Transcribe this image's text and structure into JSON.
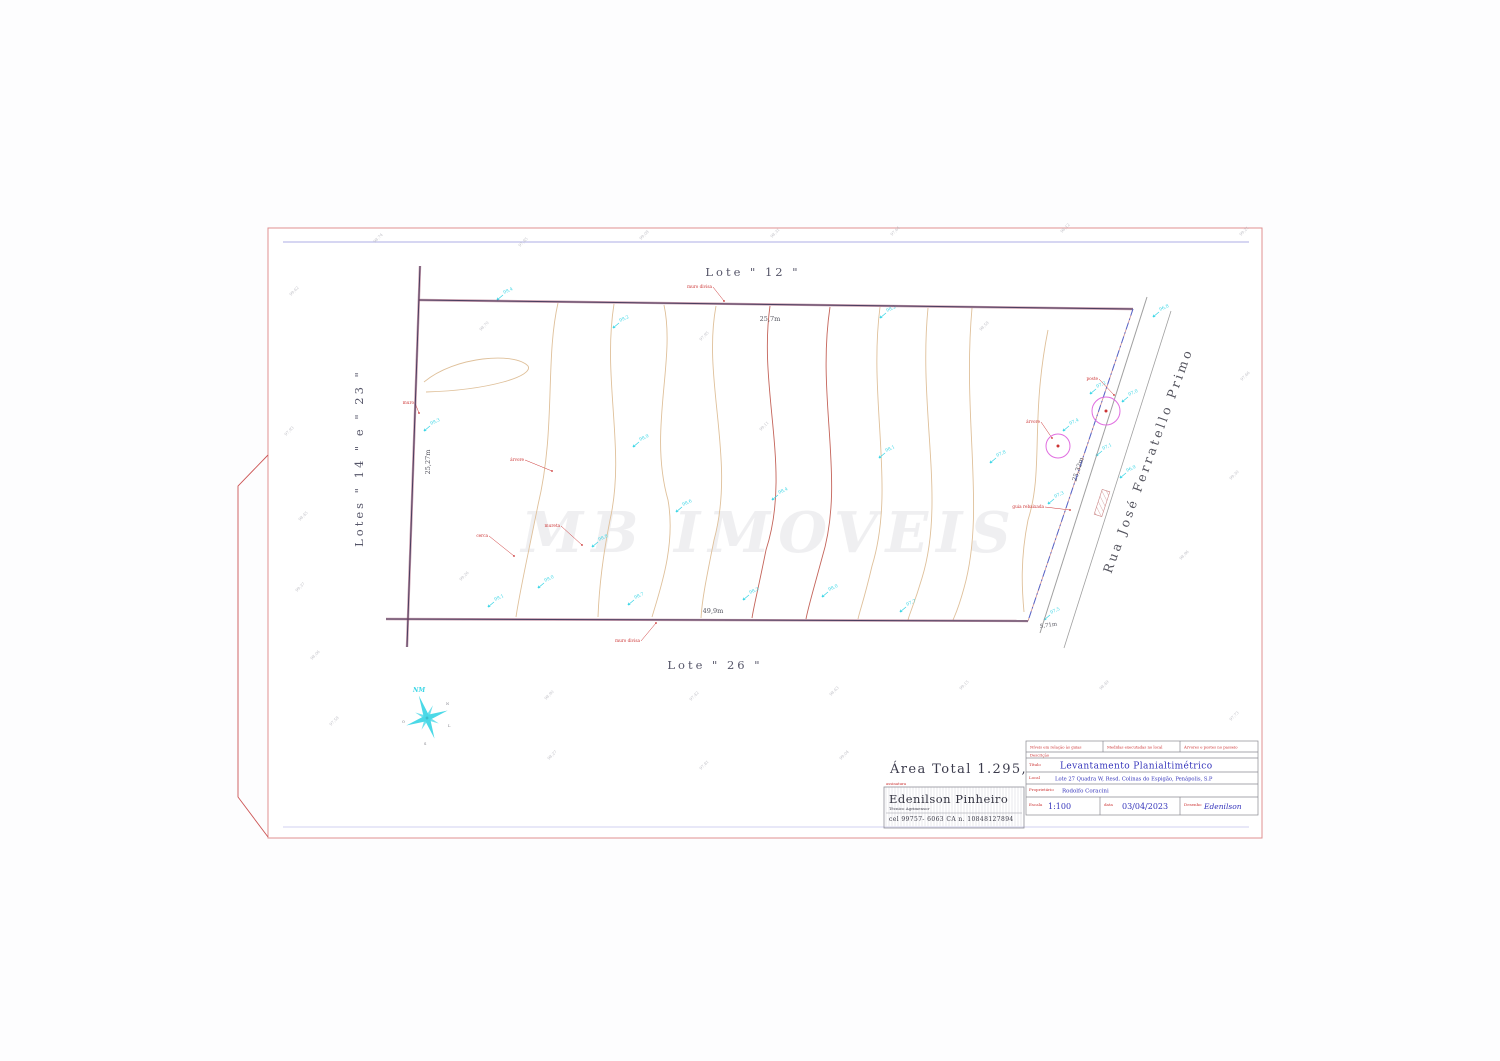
{
  "drawing": {
    "lots": {
      "top": "Lote \" 12 \"",
      "bottom": "Lote \" 26 \"",
      "left": "Lotes \" 14 \" e \" 23 \""
    },
    "street_name": "Rua José Ferratello Primo",
    "dimensions": {
      "top": "25,7m",
      "bottom": "49,9m",
      "left": "25,27m",
      "right": "25,32m",
      "extra": "5,71m"
    },
    "area_total": "Área Total 1.295,49 m2",
    "watermark": "MB IMOVEIS",
    "compass": {
      "nm": "NM",
      "micro": [
        "N",
        "L",
        "S",
        "O"
      ]
    }
  },
  "surveyor_card": {
    "tag": "assinatura",
    "name": "Edenilson Pinheiro",
    "role": "Técnico Agrimensor",
    "phone": "cel 99757- 6063 CA n. 10848127894"
  },
  "title_block": {
    "header_cells": [
      "Níveis em relação às guias",
      "Medidas executadas no local",
      "Árvores e postes no passeio"
    ],
    "descricao": "Descrição",
    "fields": {
      "titulo": {
        "label": "Título",
        "value": "Levantamento Planialtimétrico"
      },
      "local": {
        "label": "Local",
        "value": "Lote 27 Quadra W, Resd. Colinas do Espigão, Penápolis, S.P"
      },
      "proprietario": {
        "label": "Proprietário",
        "value": "Rodolfo Coracini"
      },
      "escala": {
        "label": "Escala",
        "value": "1:100"
      },
      "data": {
        "label": "data",
        "value": "03/04/2023"
      },
      "desenho": {
        "label": "Desenho",
        "value": "Edenilson"
      }
    }
  },
  "survey_points": [
    {
      "x": 613,
      "y": 328,
      "label": "99,2"
    },
    {
      "x": 633,
      "y": 447,
      "label": "98,9"
    },
    {
      "x": 676,
      "y": 512,
      "label": "98,6"
    },
    {
      "x": 772,
      "y": 500,
      "label": "98,4"
    },
    {
      "x": 879,
      "y": 458,
      "label": "98,1"
    },
    {
      "x": 990,
      "y": 463,
      "label": "97,8"
    },
    {
      "x": 592,
      "y": 547,
      "label": "98,8"
    },
    {
      "x": 538,
      "y": 588,
      "label": "99,0"
    },
    {
      "x": 488,
      "y": 607,
      "label": "99,1"
    },
    {
      "x": 628,
      "y": 605,
      "label": "98,7"
    },
    {
      "x": 743,
      "y": 600,
      "label": "98,3"
    },
    {
      "x": 822,
      "y": 597,
      "label": "98,0"
    },
    {
      "x": 900,
      "y": 612,
      "label": "97,7"
    },
    {
      "x": 1090,
      "y": 394,
      "label": "97,2"
    },
    {
      "x": 1122,
      "y": 402,
      "label": "97,0"
    },
    {
      "x": 1063,
      "y": 431,
      "label": "97,4"
    },
    {
      "x": 1096,
      "y": 456,
      "label": "97,1"
    },
    {
      "x": 1048,
      "y": 504,
      "label": "97,3"
    },
    {
      "x": 1120,
      "y": 478,
      "label": "96,9"
    },
    {
      "x": 1044,
      "y": 620,
      "label": "97,5"
    },
    {
      "x": 424,
      "y": 431,
      "label": "99,3"
    },
    {
      "x": 497,
      "y": 300,
      "label": "99,4"
    },
    {
      "x": 880,
      "y": 318,
      "label": "98,2"
    },
    {
      "x": 1153,
      "y": 317,
      "label": "96,8"
    }
  ],
  "red_annotations": [
    {
      "x": 712,
      "y": 288,
      "lx": 724,
      "ly": 301,
      "text": "muro divisa"
    },
    {
      "x": 640,
      "y": 642,
      "lx": 656,
      "ly": 623,
      "text": "muro divisa"
    },
    {
      "x": 524,
      "y": 461,
      "lx": 552,
      "ly": 471,
      "text": "árvore"
    },
    {
      "x": 488,
      "y": 537,
      "lx": 514,
      "ly": 556,
      "text": "cerca"
    },
    {
      "x": 560,
      "y": 527,
      "lx": 582,
      "ly": 545,
      "text": "mureta"
    },
    {
      "x": 414,
      "y": 404,
      "lx": 419,
      "ly": 413,
      "text": "muro"
    },
    {
      "x": 1040,
      "y": 423,
      "lx": 1052,
      "ly": 438,
      "text": "árvore"
    },
    {
      "x": 1098,
      "y": 380,
      "lx": 1114,
      "ly": 395,
      "text": "poste"
    },
    {
      "x": 1044,
      "y": 508,
      "lx": 1070,
      "ly": 510,
      "text": "guia rebaixada"
    }
  ],
  "micro_texts": [
    {
      "x": 291,
      "y": 296,
      "text": "99,62"
    },
    {
      "x": 375,
      "y": 243,
      "text": "98,74"
    },
    {
      "x": 520,
      "y": 247,
      "text": "97,85"
    },
    {
      "x": 641,
      "y": 240,
      "text": "99,08"
    },
    {
      "x": 772,
      "y": 238,
      "text": "98,31"
    },
    {
      "x": 892,
      "y": 236,
      "text": "97,64"
    },
    {
      "x": 1062,
      "y": 233,
      "text": "98,12"
    },
    {
      "x": 1241,
      "y": 236,
      "text": "99,21"
    },
    {
      "x": 286,
      "y": 436,
      "text": "97,93"
    },
    {
      "x": 300,
      "y": 521,
      "text": "98,45"
    },
    {
      "x": 297,
      "y": 592,
      "text": "99,37"
    },
    {
      "x": 312,
      "y": 660,
      "text": "98,06"
    },
    {
      "x": 331,
      "y": 726,
      "text": "97,58"
    },
    {
      "x": 546,
      "y": 700,
      "text": "98,90"
    },
    {
      "x": 691,
      "y": 701,
      "text": "97,42"
    },
    {
      "x": 831,
      "y": 696,
      "text": "98,63"
    },
    {
      "x": 961,
      "y": 690,
      "text": "99,15"
    },
    {
      "x": 549,
      "y": 760,
      "text": "98,27"
    },
    {
      "x": 701,
      "y": 770,
      "text": "97,81"
    },
    {
      "x": 841,
      "y": 760,
      "text": "99,04"
    },
    {
      "x": 1101,
      "y": 690,
      "text": "98,49"
    },
    {
      "x": 1231,
      "y": 721,
      "text": "97,73"
    },
    {
      "x": 1181,
      "y": 560,
      "text": "98,96"
    },
    {
      "x": 1231,
      "y": 480,
      "text": "99,30"
    },
    {
      "x": 1242,
      "y": 381,
      "text": "97,66"
    },
    {
      "x": 981,
      "y": 331,
      "text": "98,58"
    },
    {
      "x": 761,
      "y": 431,
      "text": "99,11"
    },
    {
      "x": 701,
      "y": 341,
      "text": "97,95"
    },
    {
      "x": 481,
      "y": 331,
      "text": "98,70"
    },
    {
      "x": 461,
      "y": 581,
      "text": "99,26"
    }
  ],
  "contours": [
    {
      "d": "M558,303 C545,360 556,430 538,505 C528,555 520,590 516,617",
      "c": "tan"
    },
    {
      "d": "M614,304 C602,380 626,450 610,520 C602,560 599,590 598,617",
      "c": "tan"
    },
    {
      "d": "M664,305 C676,360 648,430 668,500 C676,545 660,590 652,617",
      "c": "tan"
    },
    {
      "d": "M716,306 C702,380 736,460 714,540 C706,580 702,600 701,618",
      "c": "tan"
    },
    {
      "d": "M770,306 C758,390 792,470 766,550 C758,590 754,605 752,618",
      "c": "red"
    },
    {
      "d": "M830,307 C816,400 846,480 822,558 C812,595 808,608 806,619",
      "c": "red"
    },
    {
      "d": "M880,307 C868,400 896,488 872,566 C864,600 860,610 858,619",
      "c": "tan"
    },
    {
      "d": "M928,308 C918,410 946,500 922,578 C914,605 910,612 908,620",
      "c": "tan"
    },
    {
      "d": "M972,308 C962,420 986,510 964,588 C958,610 955,615 953,620",
      "c": "tan"
    },
    {
      "d": "M1048,330 C1030,420 1044,470 1028,520 C1020,560 1022,590 1024,612",
      "c": "tan"
    },
    {
      "d": "M424,382 C455,356 515,352 528,366 C534,376 490,390 426,392",
      "c": "tan"
    }
  ],
  "colors": {
    "cyan": "#3cd6e6",
    "magenta": "#e06ee0",
    "red": "#cc3333",
    "blue_text": "#3434bb",
    "contour_tan": "#dfc09a",
    "contour_red": "#c4645a",
    "boundary": "#4a3c5e",
    "boundary_fringe": "#9a4a6a",
    "frame_red": "#e09090",
    "line_blue": "#9a9ade",
    "street_gray": "#a0a0a0",
    "micro_gray": "#b0b0b8"
  }
}
